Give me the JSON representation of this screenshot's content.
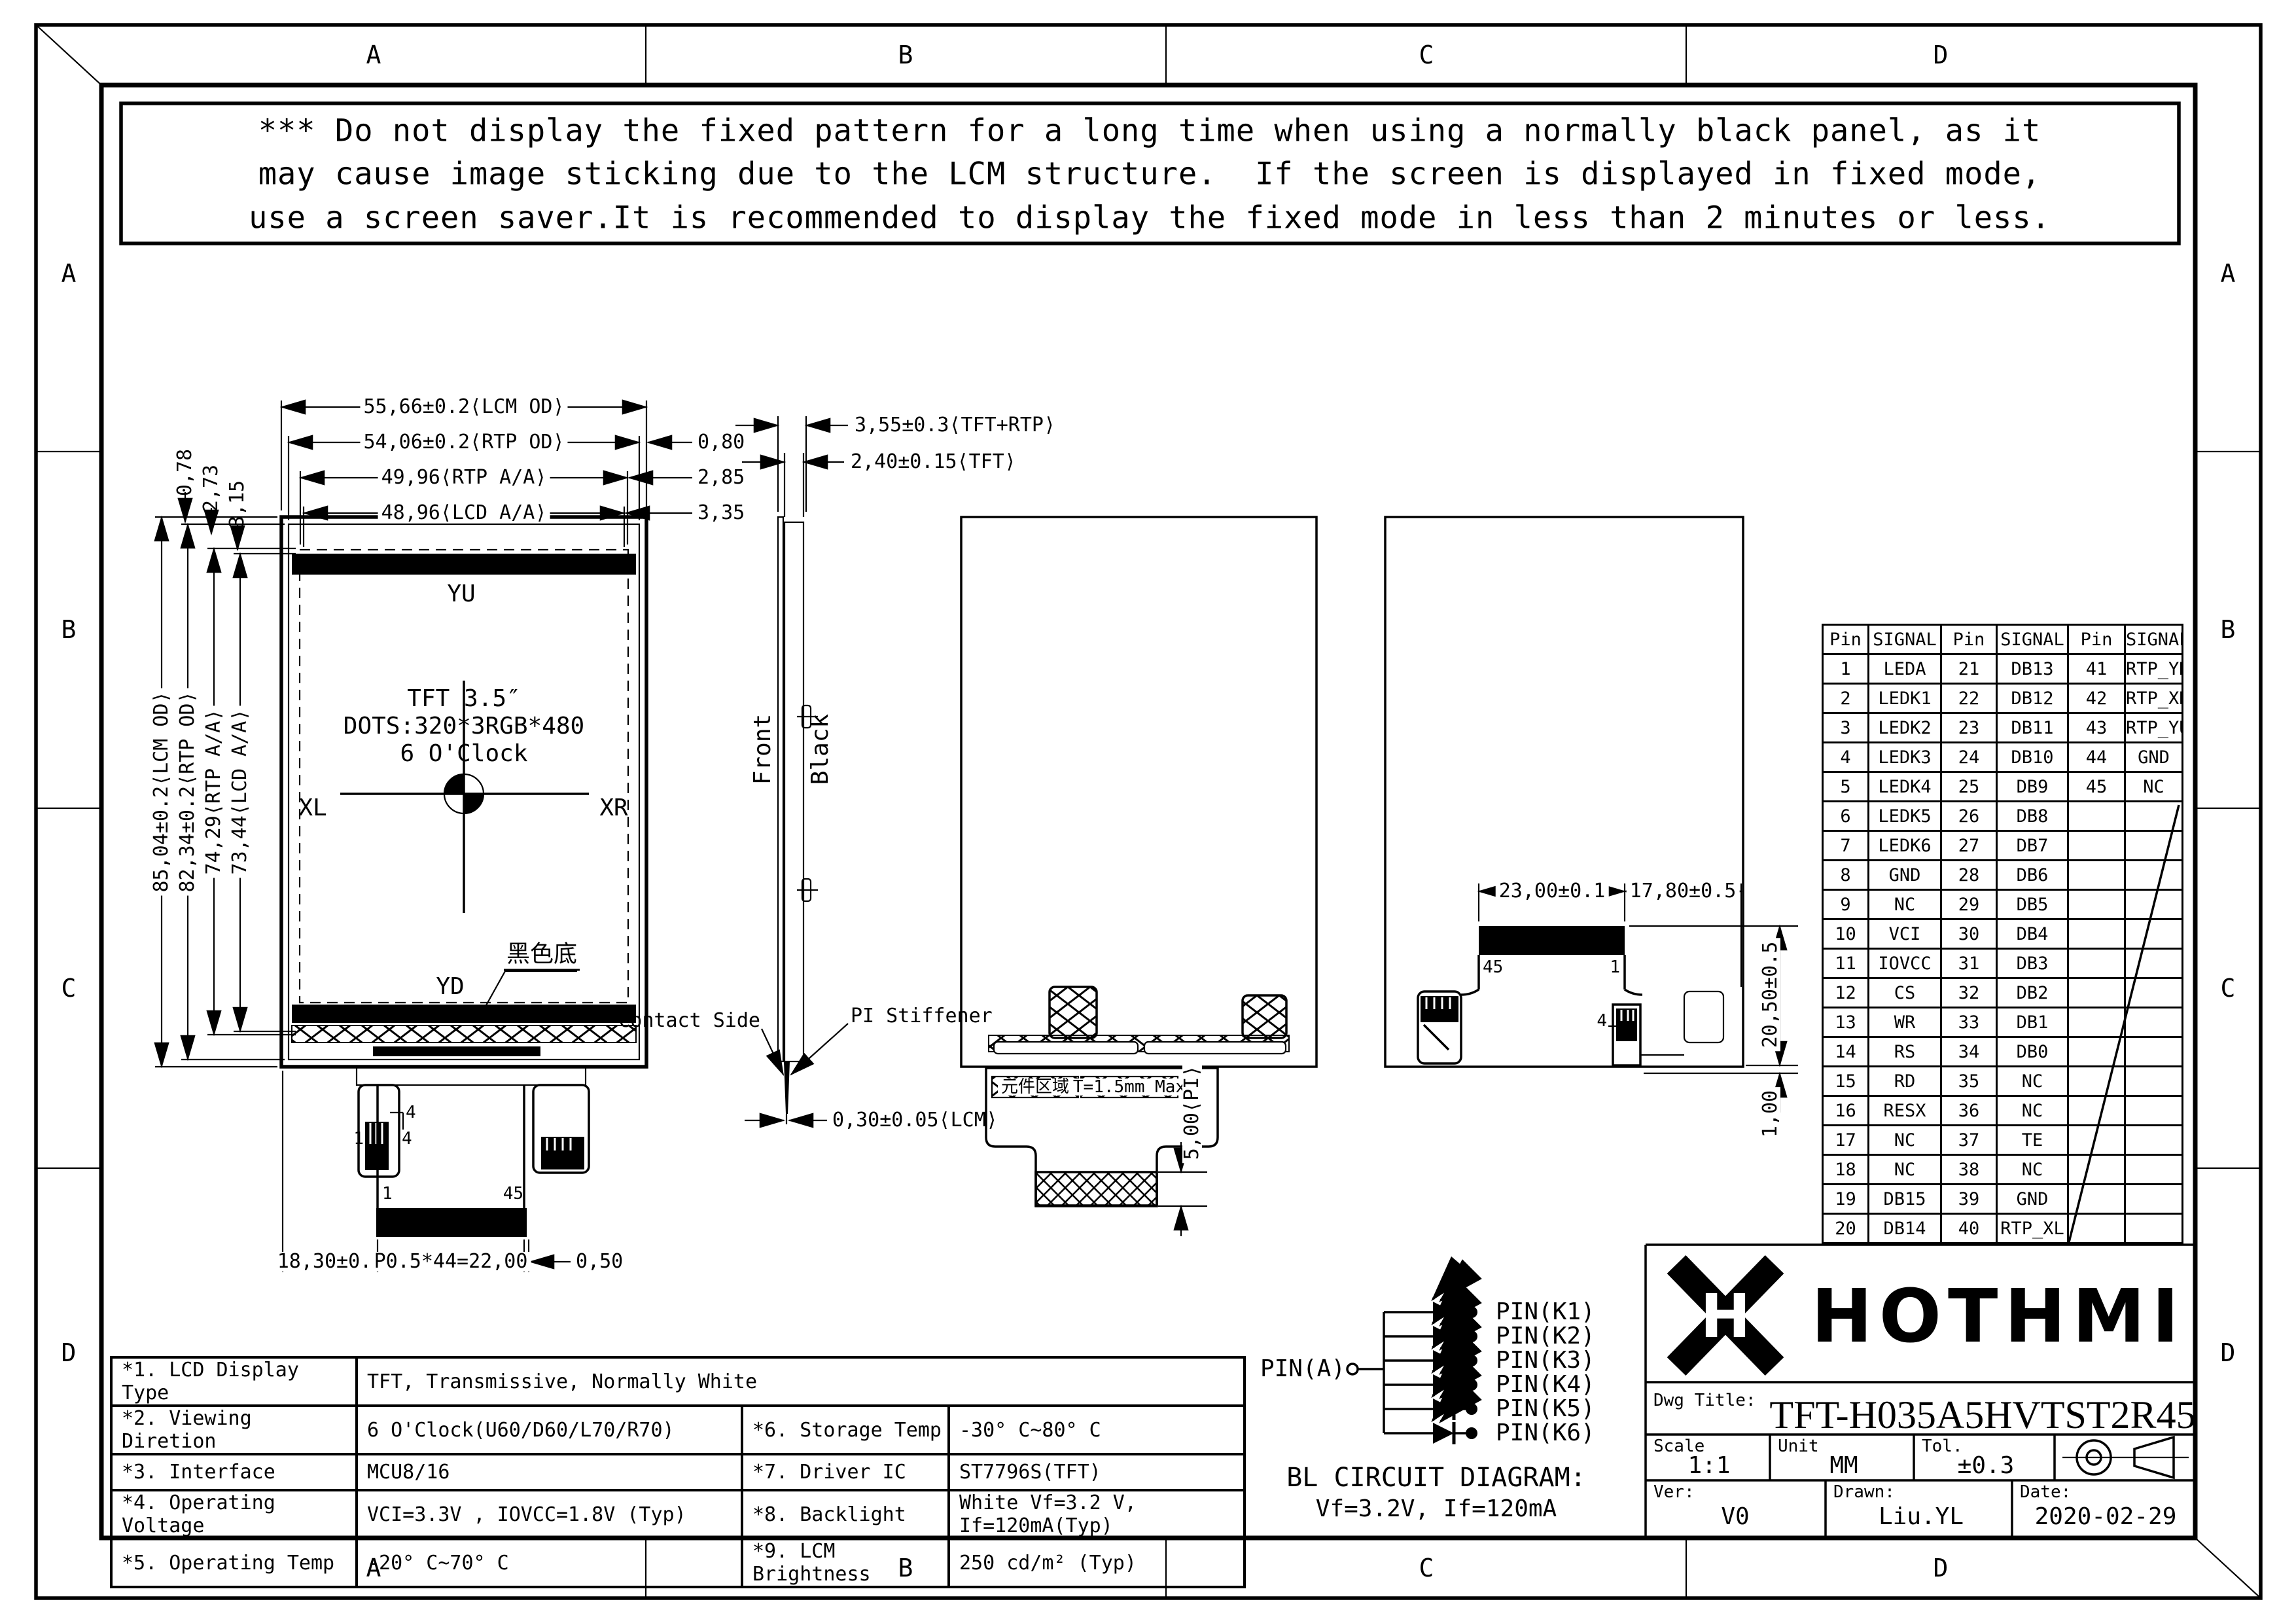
{
  "zones": {
    "cols": [
      "A",
      "B",
      "C",
      "D"
    ],
    "rows": [
      "A",
      "B",
      "C",
      "D"
    ]
  },
  "warning": {
    "line1": "*** Do not display the fixed pattern for a long time when using a normally black panel, as it",
    "line2": "may cause image sticking due to the LCM structure.  If the screen is displayed in fixed mode,",
    "line3": "use a screen saver.It is recommended to display the fixed mode in less than 2 minutes or less."
  },
  "front_view": {
    "dim_w_lcm": "55,66±0.2⟨LCM OD⟩",
    "dim_w_rtp": "54,06±0.2⟨RTP OD⟩",
    "dim_w_rtpaa": "49,96⟨RTP A/A⟩",
    "dim_w_lcdaa": "48,96⟨LCD A/A⟩",
    "off_r1": "0,80",
    "off_r2": "2,85",
    "off_r3": "3,35",
    "off_t1": "0,78",
    "off_t2": "2,73",
    "off_t3": "3,15",
    "dim_h_lcm": "85,04±0.2⟨LCM OD⟩",
    "dim_h_rtp": "82,34±0.2⟨RTP OD⟩",
    "dim_h_rtpaa": "74,29⟨RTP A/A⟩",
    "dim_h_lcdaa": "73,44⟨LCD A/A⟩",
    "label_yu": "YU",
    "label_yd": "YD",
    "label_xl": "XL",
    "label_xr": "XR",
    "label_black_bg": "黑色底",
    "center_line1": "TFT 3.5″",
    "center_line2": "DOTS:320*3RGB*480",
    "center_line3": "6 O'Clock",
    "pin_1": "1",
    "pin_45": "45",
    "pin_4a": "4",
    "pin_4b": "4",
    "pin_1b": "1",
    "dim_fpc_left": "18,30±0.5",
    "dim_fpc_pitch": "P0.5*44=22,00",
    "dim_fpc_right": "0,50"
  },
  "side_view": {
    "dim_total": "3,55±0.3⟨TFT+RTP⟩",
    "dim_tft": "2,40±0.15⟨TFT⟩",
    "dim_fpc": "0,30±0.05⟨LCM⟩",
    "label_front": "Front",
    "label_black": "Black",
    "label_contact": "Contact Side",
    "label_stiffener": "PI Stiffener"
  },
  "back_view_mid": {
    "component_area": "元件区域",
    "thickness": "T=1.5mm Max",
    "dim_pi": "5,00⟨PI⟩"
  },
  "back_view_right": {
    "dim_w1": "23,00±0.1",
    "dim_w2": "17,80±0.5",
    "dim_h1": "20,50±0.5",
    "dim_h2": "1,00",
    "pin_45": "45",
    "pin_1": "1",
    "pin_4": "4"
  },
  "pin_table": {
    "headers": [
      "Pin",
      "SIGNAL",
      "Pin",
      "SIGNAL",
      "Pin",
      "SIGNAL"
    ],
    "rows": [
      [
        "1",
        "LEDA",
        "21",
        "DB13",
        "41",
        "RTP_YD"
      ],
      [
        "2",
        "LEDK1",
        "22",
        "DB12",
        "42",
        "RTP_XR"
      ],
      [
        "3",
        "LEDK2",
        "23",
        "DB11",
        "43",
        "RTP_YU"
      ],
      [
        "4",
        "LEDK3",
        "24",
        "DB10",
        "44",
        "GND"
      ],
      [
        "5",
        "LEDK4",
        "25",
        "DB9",
        "45",
        "NC"
      ],
      [
        "6",
        "LEDK5",
        "26",
        "DB8",
        "",
        ""
      ],
      [
        "7",
        "LEDK6",
        "27",
        "DB7",
        "",
        ""
      ],
      [
        "8",
        "GND",
        "28",
        "DB6",
        "",
        ""
      ],
      [
        "9",
        "NC",
        "29",
        "DB5",
        "",
        ""
      ],
      [
        "10",
        "VCI",
        "30",
        "DB4",
        "",
        ""
      ],
      [
        "11",
        "IOVCC",
        "31",
        "DB3",
        "",
        ""
      ],
      [
        "12",
        "CS",
        "32",
        "DB2",
        "",
        ""
      ],
      [
        "13",
        "WR",
        "33",
        "DB1",
        "",
        ""
      ],
      [
        "14",
        "RS",
        "34",
        "DB0",
        "",
        ""
      ],
      [
        "15",
        "RD",
        "35",
        "NC",
        "",
        ""
      ],
      [
        "16",
        "RESX",
        "36",
        "NC",
        "",
        ""
      ],
      [
        "17",
        "NC",
        "37",
        "TE",
        "",
        ""
      ],
      [
        "18",
        "NC",
        "38",
        "NC",
        "",
        ""
      ],
      [
        "19",
        "DB15",
        "39",
        "GND",
        "",
        ""
      ],
      [
        "20",
        "DB14",
        "40",
        "RTP_XL",
        "",
        ""
      ]
    ]
  },
  "bl_circuit": {
    "anode": "PIN(A)",
    "cathodes": [
      "PIN(K1)",
      "PIN(K2)",
      "PIN(K3)",
      "PIN(K4)",
      "PIN(K5)",
      "PIN(K6)"
    ],
    "title": "BL CIRCUIT DIAGRAM:",
    "subtitle": "Vf=3.2V, If=120mA"
  },
  "spec_table": {
    "r1": {
      "l": "*1. LCD Display Type",
      "v": "TFT, Transmissive, Normally White"
    },
    "r2": {
      "l": "*2. Viewing Diretion",
      "v": "6 O'Clock(U60/D60/L70/R70)",
      "l2": "*6. Storage Temp",
      "v2": "-30° C~80° C"
    },
    "r3": {
      "l": "*3. Interface",
      "v": "MCU8/16",
      "l2": "*7. Driver IC",
      "v2": "ST7796S(TFT)"
    },
    "r4": {
      "l": "*4. Operating Voltage",
      "v": "VCI=3.3V , IOVCC=1.8V (Typ)",
      "l2": "*8. Backlight",
      "v2": "White Vf=3.2 V, If=120mA(Typ)"
    },
    "r5": {
      "l": "*5. Operating Temp",
      "v": "-20° C~70° C",
      "l2": "*9. LCM Brightness",
      "v2": "250 cd/m² (Typ)"
    }
  },
  "title_block": {
    "brand": "HOTHMI",
    "logo_letter": "H",
    "dwg_title_label": "Dwg Title:",
    "dwg_title": "TFT-H035A5HVTST2R45",
    "scale_label": "Scale",
    "scale": "1:1",
    "unit_label": "Unit",
    "unit": "MM",
    "tol_label": "Tol.",
    "tol": "±0.3",
    "ver_label": "Ver:",
    "ver": "V0",
    "drawn_label": "Drawn:",
    "drawn": "Liu.YL",
    "date_label": "Date:",
    "date": "2020-02-29"
  }
}
